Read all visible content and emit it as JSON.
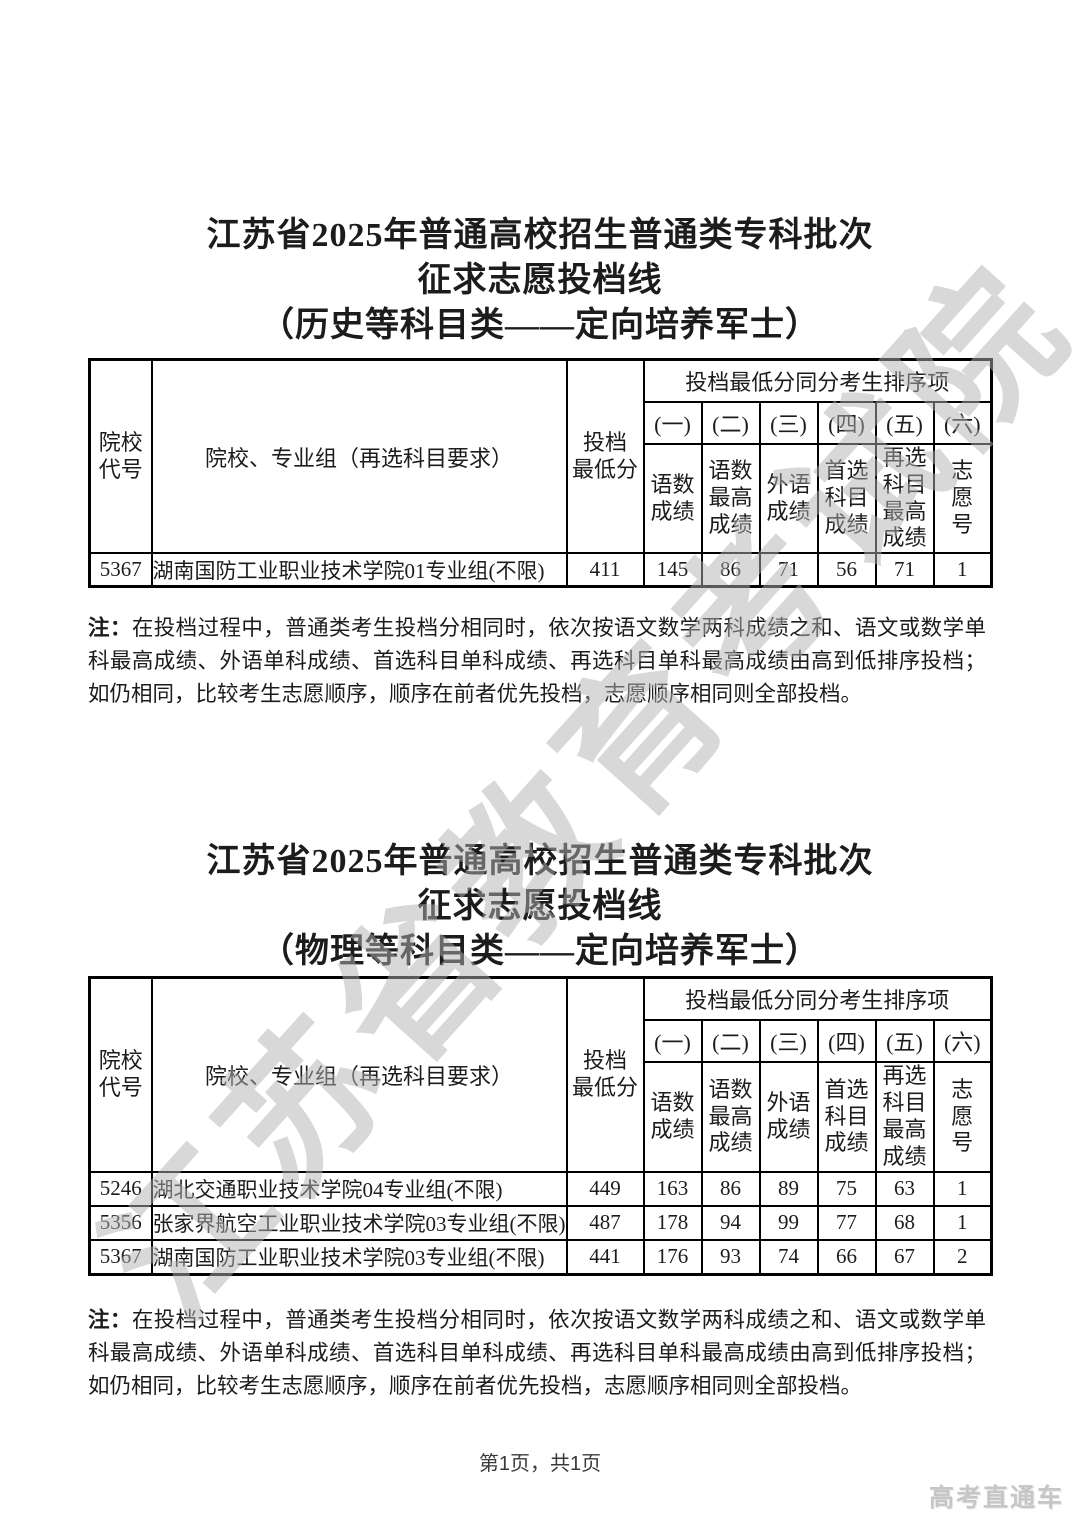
{
  "page": {
    "watermark": "江苏省教育考试院",
    "footer_page": "第1页，共1页",
    "brand": "高考直通车"
  },
  "colors": {
    "text": "#1c1c1c",
    "border": "#000000",
    "watermark": "#b1b1b1",
    "brand": "#c6c6c6",
    "background": "#ffffff"
  },
  "sections": [
    {
      "title_lines": [
        "江苏省2025年普通高校招生普通类专科批次",
        "征求志愿投档线",
        "（历史等科目类——定向培养军士）"
      ],
      "table": {
        "header": {
          "school_code": "院校\n代号",
          "school_group": "院校、专业组（再选科目要求）",
          "min_score": "投档\n最低分",
          "tiebreak_title": "投档最低分同分考生排序项",
          "tiebreak_nums": [
            "(一)",
            "(二)",
            "(三)",
            "(四)",
            "(五)",
            "(六)"
          ],
          "tiebreak_labels": [
            "语数\n成绩",
            "语数\n最高\n成绩",
            "外语\n成绩",
            "首选\n科目\n成绩",
            "再选\n科目\n最高\n成绩",
            "志\n愿\n号"
          ]
        },
        "rows": [
          {
            "code": "5367",
            "group": "湖南国防工业职业技术学院01专业组(不限)",
            "min_score": "411",
            "tiebreak": [
              "145",
              "86",
              "71",
              "56",
              "71",
              "1"
            ]
          }
        ]
      },
      "note": {
        "label": "注：",
        "text": "在投档过程中，普通类考生投档分相同时，依次按语文数学两科成绩之和、语文或数学单科最高成绩、外语单科成绩、首选科目单科成绩、再选科目单科最高成绩由高到低排序投档；如仍相同，比较考生志愿顺序，顺序在前者优先投档，志愿顺序相同则全部投档。"
      }
    },
    {
      "title_lines": [
        "江苏省2025年普通高校招生普通类专科批次",
        "征求志愿投档线",
        "（物理等科目类——定向培养军士）"
      ],
      "table": {
        "header": {
          "school_code": "院校\n代号",
          "school_group": "院校、专业组（再选科目要求）",
          "min_score": "投档\n最低分",
          "tiebreak_title": "投档最低分同分考生排序项",
          "tiebreak_nums": [
            "(一)",
            "(二)",
            "(三)",
            "(四)",
            "(五)",
            "(六)"
          ],
          "tiebreak_labels": [
            "语数\n成绩",
            "语数\n最高\n成绩",
            "外语\n成绩",
            "首选\n科目\n成绩",
            "再选\n科目\n最高\n成绩",
            "志\n愿\n号"
          ]
        },
        "rows": [
          {
            "code": "5246",
            "group": "湖北交通职业技术学院04专业组(不限)",
            "min_score": "449",
            "tiebreak": [
              "163",
              "86",
              "89",
              "75",
              "63",
              "1"
            ]
          },
          {
            "code": "5356",
            "group": "张家界航空工业职业技术学院03专业组(不限)",
            "min_score": "487",
            "tiebreak": [
              "178",
              "94",
              "99",
              "77",
              "68",
              "1"
            ]
          },
          {
            "code": "5367",
            "group": "湖南国防工业职业技术学院03专业组(不限)",
            "min_score": "441",
            "tiebreak": [
              "176",
              "93",
              "74",
              "66",
              "67",
              "2"
            ]
          }
        ]
      },
      "note": {
        "label": "注：",
        "text": "在投档过程中，普通类考生投档分相同时，依次按语文数学两科成绩之和、语文或数学单科最高成绩、外语单科成绩、首选科目单科成绩、再选科目单科最高成绩由高到低排序投档；如仍相同，比较考生志愿顺序，顺序在前者优先投档，志愿顺序相同则全部投档。"
      }
    }
  ]
}
